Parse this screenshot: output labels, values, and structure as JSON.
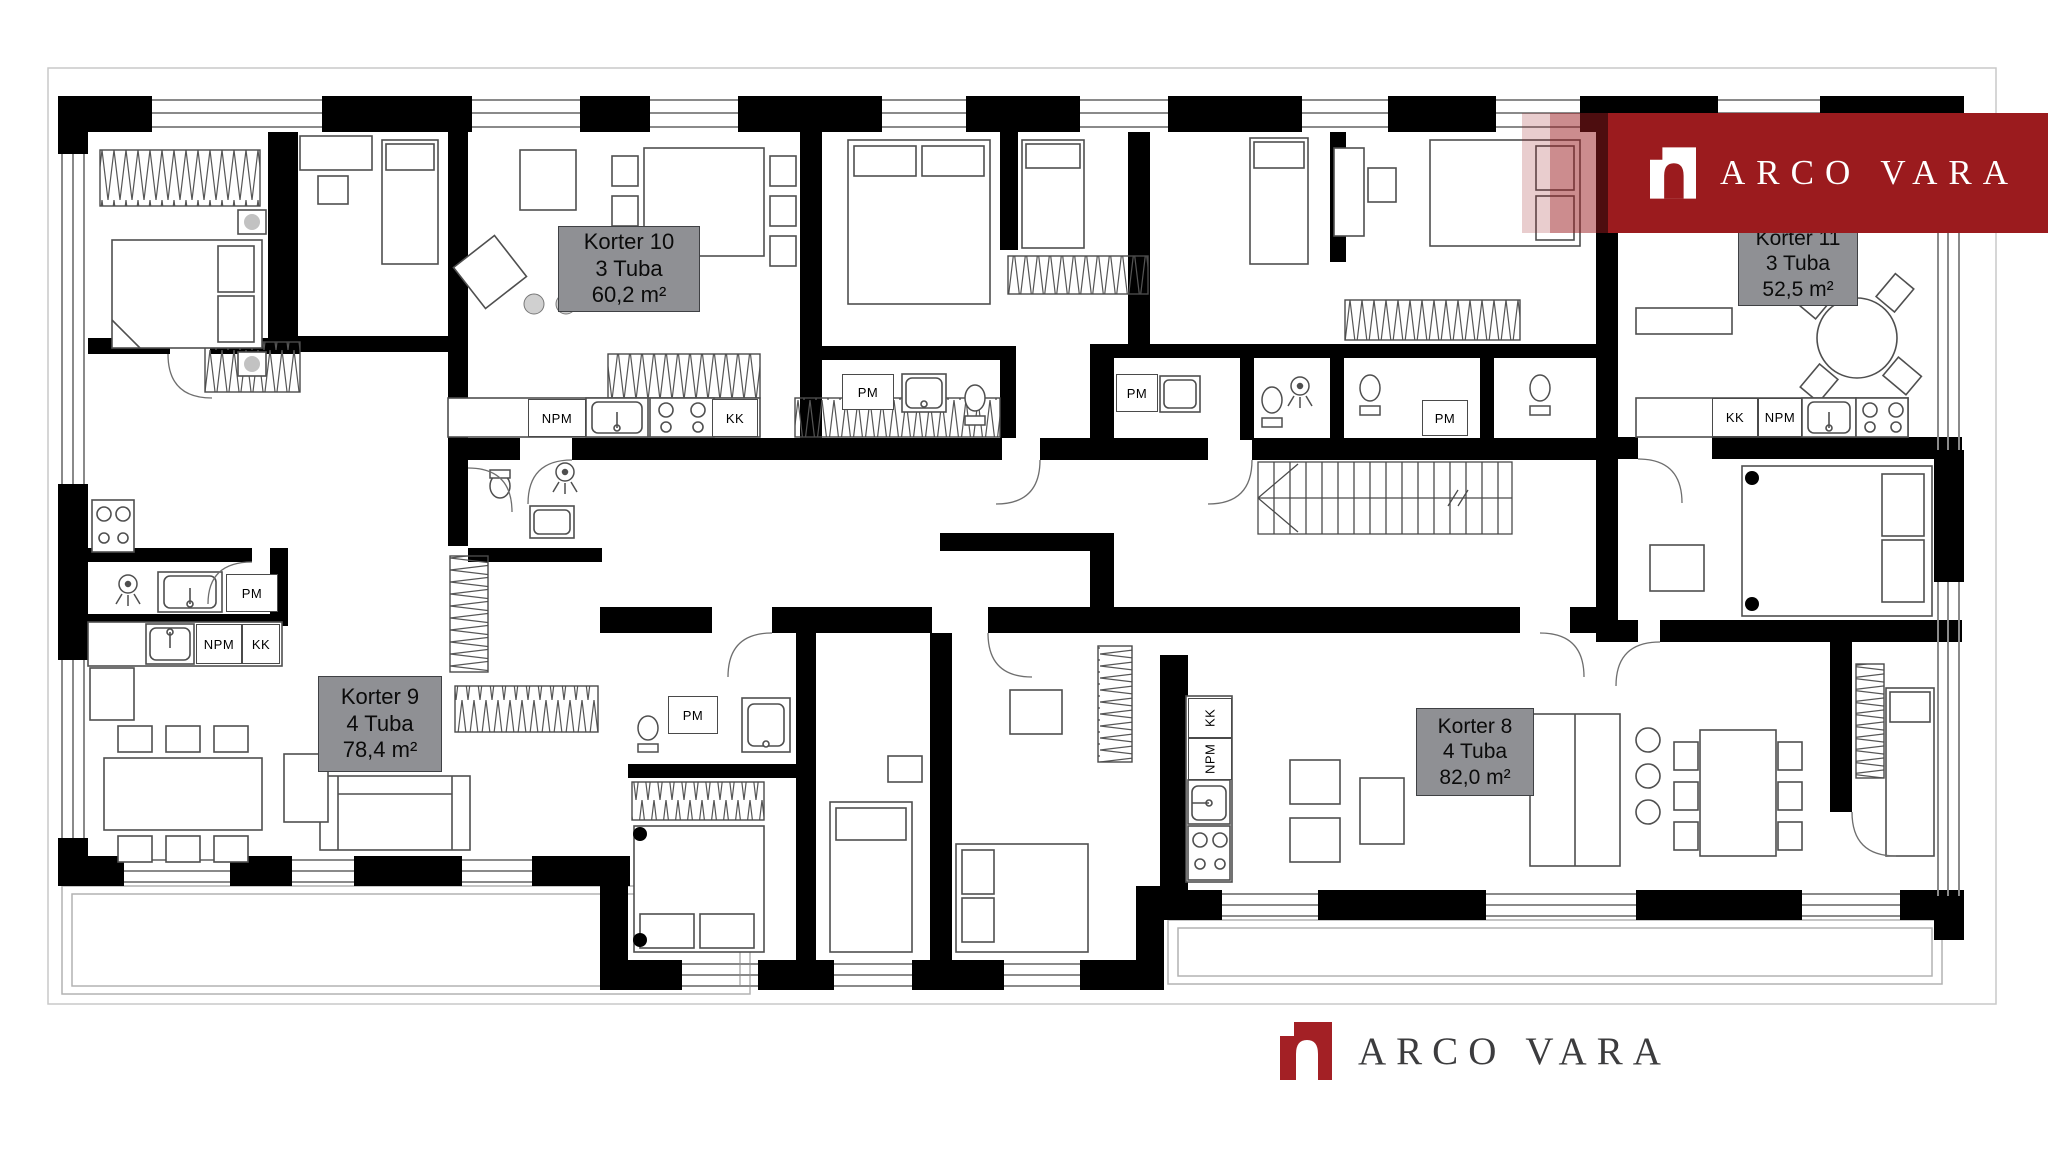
{
  "page": {
    "background": "#ffffff",
    "description": "Apartment building floor plan"
  },
  "brand": {
    "name": "ARCO VARA",
    "banner": {
      "text": "ARCO VARA",
      "bg_color": "#9B1B1E",
      "text_color": "#ffffff",
      "logo": "arco-vara-arch-logo"
    },
    "footer": {
      "text": "ARCO VARA",
      "logo_color": "#A32025",
      "text_color": "#3C3C3E",
      "logo": "arco-vara-arch-logo"
    }
  },
  "apartments": [
    {
      "name": "Korter 10",
      "rooms": "3 Tuba",
      "area": "60,2 m²",
      "label_bg": "#8F9094"
    },
    {
      "name": "Korter 11",
      "rooms": "3 Tuba",
      "area": "52,5 m²",
      "label_bg": "#8F9094"
    },
    {
      "name": "Korter 9",
      "rooms": "4 Tuba",
      "area": "78,4 m²",
      "label_bg": "#8F9094"
    },
    {
      "name": "Korter 8",
      "rooms": "4 Tuba",
      "area": "82,0 m²",
      "label_bg": "#8F9094"
    }
  ],
  "fixture_labels": [
    {
      "text": "NPM",
      "location": "korter-10-kitchen"
    },
    {
      "text": "KK",
      "location": "korter-10-kitchen"
    },
    {
      "text": "PM",
      "location": "center-left-bathroom"
    },
    {
      "text": "PM",
      "location": "center-hall-bathroom"
    },
    {
      "text": "PM",
      "location": "center-right-bathroom"
    },
    {
      "text": "PM",
      "location": "korter-9-bathroom"
    },
    {
      "text": "NPM",
      "location": "korter-9-kitchen"
    },
    {
      "text": "KK",
      "location": "korter-9-kitchen"
    },
    {
      "text": "KK",
      "location": "korter-11-kitchen"
    },
    {
      "text": "NPM",
      "location": "korter-11-kitchen"
    },
    {
      "text": "KK",
      "location": "korter-8-kitchen"
    },
    {
      "text": "NPM",
      "location": "korter-8-kitchen"
    },
    {
      "text": "PM",
      "location": "bottom-center-bathroom"
    }
  ]
}
